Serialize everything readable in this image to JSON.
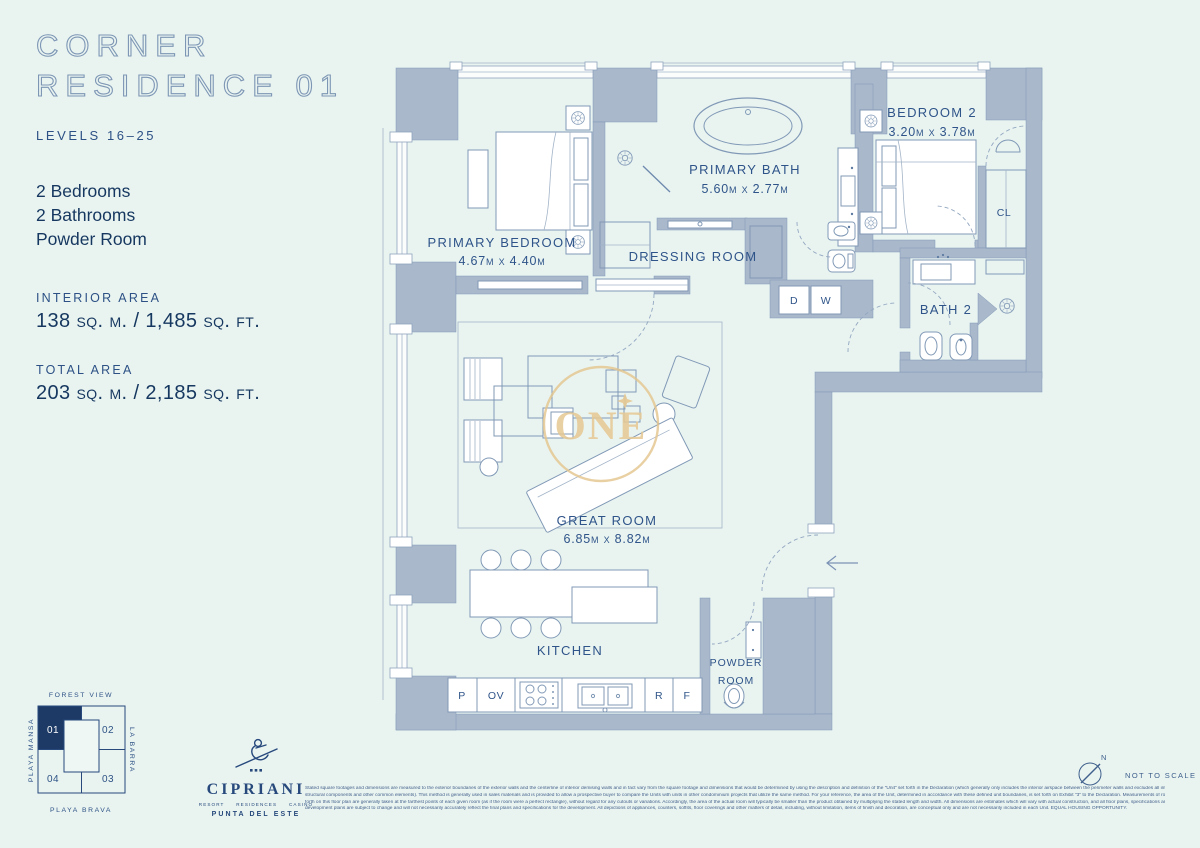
{
  "colors": {
    "background": "#e9f4f1",
    "wall": "#a9b8cb",
    "navy": "#16375f",
    "label_blue": "#2f5489",
    "gold": "#e4c48c",
    "highlight_cell": "#1d3a66"
  },
  "sidebar": {
    "title_line1": "CORNER",
    "title_line2": "RESIDENCE 01",
    "levels": "LEVELS 16–25",
    "features": [
      "2 Bedrooms",
      "2 Bathrooms",
      "Powder Room"
    ],
    "interior_area_label": "INTERIOR AREA",
    "interior_area_value": "138 sq. m. / 1,485 sq. ft.",
    "total_area_label": "TOTAL AREA",
    "total_area_value": "203 sq. m. / 2,185 sq. ft."
  },
  "plan": {
    "watermark": "ONE",
    "rooms": {
      "primary_bedroom": {
        "name": "PRIMARY BEDROOM",
        "dims": "4.67m x 4.40m"
      },
      "primary_bath": {
        "name": "PRIMARY BATH",
        "dims": "5.60m x 2.77m"
      },
      "dressing_room": {
        "name": "DRESSING ROOM"
      },
      "bedroom_2": {
        "name": "BEDROOM 2",
        "dims": "3.20m x 3.78m"
      },
      "bath_2": {
        "name": "BATH 2"
      },
      "closet": {
        "label": "CL"
      },
      "great_room": {
        "name": "GREAT ROOM",
        "dims": "6.85m x 8.82m"
      },
      "kitchen": {
        "name": "KITCHEN"
      },
      "powder_room": {
        "line1": "POWDER",
        "line2": "ROOM"
      }
    },
    "appliances": {
      "pantry": "P",
      "oven": "OV",
      "refrigerator": "R",
      "freezer": "F",
      "dryer": "D",
      "washer": "W"
    }
  },
  "keyplan": {
    "top": "FOREST VIEW",
    "left": "PLAYA MANSA",
    "right": "LA BARRA",
    "bottom": "PLAYA BRAVA",
    "units": [
      "01",
      "02",
      "03",
      "04"
    ],
    "highlighted_unit": "01"
  },
  "brand": {
    "name": "CIPRIANI",
    "subtitle": "RESORT     RESIDENCES     CASINO",
    "location": "PUNTA DEL ESTE"
  },
  "compass": {
    "north": "N",
    "note": "NOT TO SCALE"
  },
  "disclaimer": {
    "lines": [
      "Stated square footages and dimensions are measured to the exterior boundaries of the exterior walls and the centerline of interior demising walls and in fact vary from the square footage and dimensions that would be determined by using the description and definition of the \"Unit\" set forth in the Declaration (which generally only includes the interior airspace between the perimeter walls and excludes all interior",
      "structural components and other common elements). This method is generally used in sales materials and is provided to allow a prospective buyer to compare the Units with units in other condominium projects that utilize the same method. For your reference, the area of the Unit, determined in accordance with these defined unit boundaries, is set forth on Exhibit \"3\" to the Declaration. Measurements of rooms set",
      "forth on this floor plan are generally taken at the farthest points of each given room (as if the room were a perfect rectangle), without regard for any cutouts or variations. Accordingly, the area of the actual room will typically be smaller than the product obtained by multiplying the stated length and width. All dimensions are estimates which will vary with actual construction, and all floor plans, specifications and other",
      "development plans are subject to change and will not necessarily accurately reflect the final plans and specifications for the development. All depictions of appliances, counters, soffits, floor coverings and other matters of detail, including, without limitation, items of finish and decoration, are conceptual only and are not necessarily included in each Unit. EQUAL HOUSING OPPORTUNITY."
    ]
  }
}
